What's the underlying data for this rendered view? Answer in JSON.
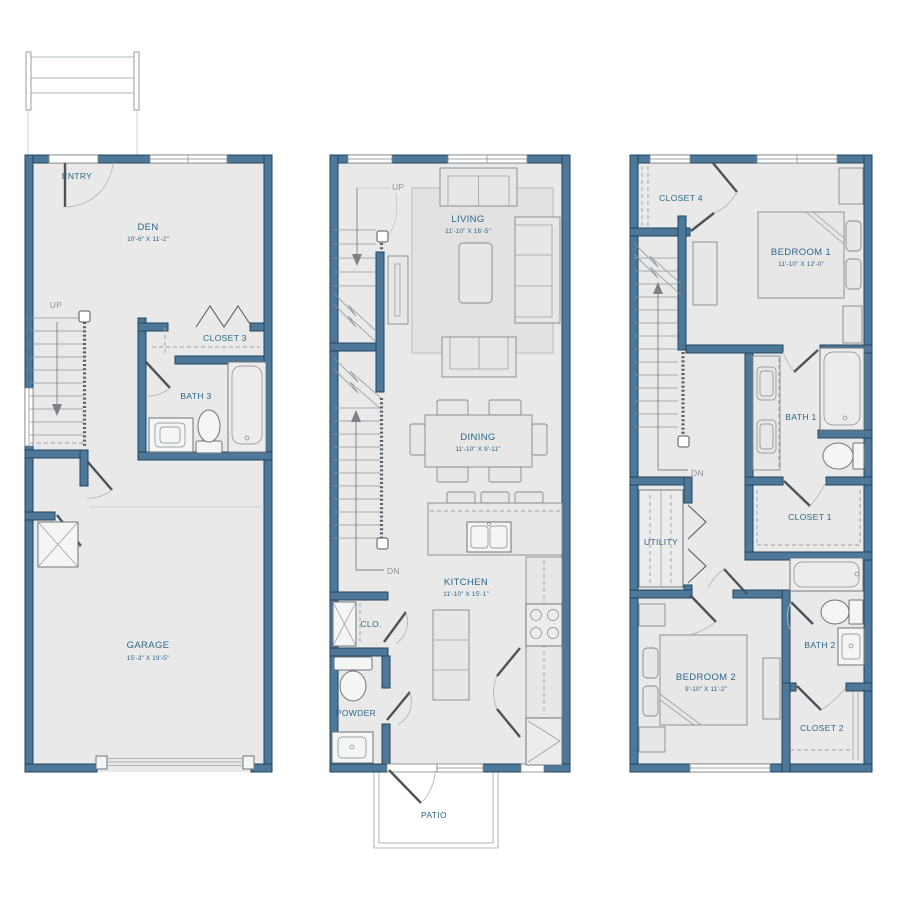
{
  "palette": {
    "background": "#ffffff",
    "wall_fill": "#4d7899",
    "wall_edge": "#23455e",
    "floor_fill": "#e9e9e9",
    "label_color": "#2d6587",
    "muted_label_color": "#8d9195"
  },
  "floor1": {
    "entry": "ENTRY",
    "up": "UP",
    "den": {
      "name": "DEN",
      "dims": "10'-6\" X 11'-2\""
    },
    "closet3": "CLOSET 3",
    "bath3": "BATH 3",
    "garage": {
      "name": "GARAGE",
      "dims": "15'-3\" X 19'-5\""
    }
  },
  "floor2": {
    "up": "UP",
    "dn": "DN",
    "living": {
      "name": "LIVING",
      "dims": "11'-10\" X 16'-5\""
    },
    "dining": {
      "name": "DINING",
      "dims": "11'-10\" X 9'-11\""
    },
    "kitchen": {
      "name": "KITCHEN",
      "dims": "11'-10\" X 15'-1\""
    },
    "clo": "CLO.",
    "powder": "POWDER",
    "patio": "PATIO"
  },
  "floor3": {
    "dn": "DN",
    "closet4": "CLOSET 4",
    "bedroom1": {
      "name": "BEDROOM 1",
      "dims": "11'-10\" X 12'-0\""
    },
    "bath1": "BATH 1",
    "closet1": "CLOSET 1",
    "utility": "UTILITY",
    "bedroom2": {
      "name": "BEDROOM 2",
      "dims": "9'-10\" X 11'-2\""
    },
    "bath2": "BATH 2",
    "closet2": "CLOSET 2"
  }
}
